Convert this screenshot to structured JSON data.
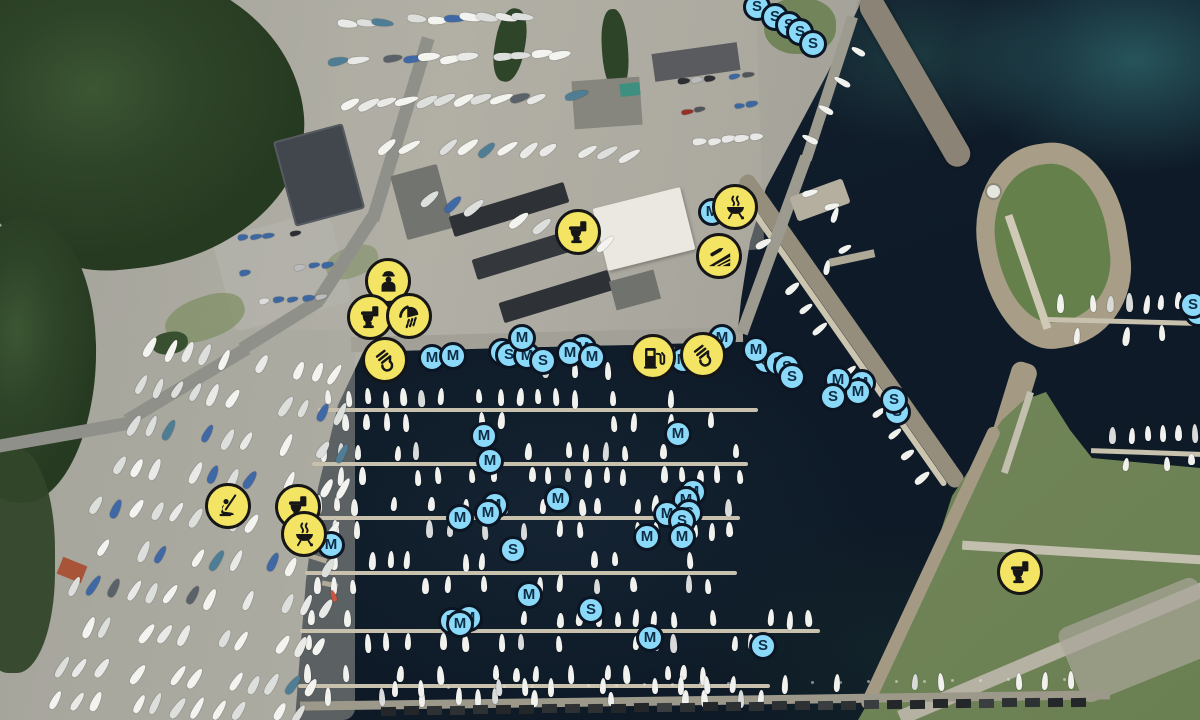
{
  "map": {
    "type": "satellite-harbour-map",
    "style": {
      "facility_fill": "#F3E464",
      "facility_stroke": "#161616",
      "facility_glyph": "#161616",
      "facility_size": 46,
      "mooring_fill": "#8AD9F8",
      "mooring_stroke": "#0B1523",
      "mooring_text": "#0D2C45",
      "mooring_size": 28
    },
    "facility_markers": [
      {
        "icon": "toilet",
        "x": 578,
        "y": 232
      },
      {
        "icon": "bbq",
        "x": 735,
        "y": 207
      },
      {
        "icon": "slipway",
        "x": 719,
        "y": 256
      },
      {
        "icon": "harbourmaster",
        "x": 388,
        "y": 281
      },
      {
        "icon": "toilet",
        "x": 370,
        "y": 317
      },
      {
        "icon": "shower",
        "x": 409,
        "y": 316
      },
      {
        "icon": "crane",
        "x": 385,
        "y": 360
      },
      {
        "icon": "fuel",
        "x": 653,
        "y": 357
      },
      {
        "icon": "crane",
        "x": 703,
        "y": 355
      },
      {
        "icon": "playground",
        "x": 228,
        "y": 506
      },
      {
        "icon": "toilet",
        "x": 298,
        "y": 507
      },
      {
        "icon": "bbq",
        "x": 304,
        "y": 534
      },
      {
        "icon": "toilet",
        "x": 1020,
        "y": 572
      }
    ],
    "mooring_markers": [
      {
        "letter": "S",
        "x": 757,
        "y": 7
      },
      {
        "letter": "S",
        "x": 775,
        "y": 17
      },
      {
        "letter": "S",
        "x": 789,
        "y": 25
      },
      {
        "letter": "S",
        "x": 800,
        "y": 32
      },
      {
        "letter": "S",
        "x": 813,
        "y": 44
      },
      {
        "letter": "M",
        "x": 712,
        "y": 212
      },
      {
        "letter": "M",
        "x": 432,
        "y": 358
      },
      {
        "letter": "M",
        "x": 453,
        "y": 356
      },
      {
        "letter": "S",
        "x": 502,
        "y": 352
      },
      {
        "letter": "S",
        "x": 509,
        "y": 355
      },
      {
        "letter": "M",
        "x": 527,
        "y": 356
      },
      {
        "letter": "M",
        "x": 522,
        "y": 338
      },
      {
        "letter": "S",
        "x": 543,
        "y": 361
      },
      {
        "letter": "M",
        "x": 583,
        "y": 348
      },
      {
        "letter": "M",
        "x": 570,
        "y": 353
      },
      {
        "letter": "M",
        "x": 592,
        "y": 357
      },
      {
        "letter": "M",
        "x": 683,
        "y": 360
      },
      {
        "letter": "M",
        "x": 722,
        "y": 338
      },
      {
        "letter": "S",
        "x": 766,
        "y": 361
      },
      {
        "letter": "M",
        "x": 756,
        "y": 350
      },
      {
        "letter": "S",
        "x": 778,
        "y": 363
      },
      {
        "letter": "S",
        "x": 787,
        "y": 367
      },
      {
        "letter": "S",
        "x": 792,
        "y": 377
      },
      {
        "letter": "M",
        "x": 862,
        "y": 383
      },
      {
        "letter": "M",
        "x": 858,
        "y": 392
      },
      {
        "letter": "M",
        "x": 838,
        "y": 380
      },
      {
        "letter": "S",
        "x": 833,
        "y": 397
      },
      {
        "letter": "S",
        "x": 897,
        "y": 412
      },
      {
        "letter": "S",
        "x": 894,
        "y": 400
      },
      {
        "letter": "S",
        "x": 1198,
        "y": 313
      },
      {
        "letter": "S",
        "x": 1193,
        "y": 305
      },
      {
        "letter": "M",
        "x": 484,
        "y": 436
      },
      {
        "letter": "M",
        "x": 490,
        "y": 461
      },
      {
        "letter": "M",
        "x": 678,
        "y": 434
      },
      {
        "letter": "M",
        "x": 558,
        "y": 499
      },
      {
        "letter": "M",
        "x": 495,
        "y": 505
      },
      {
        "letter": "M",
        "x": 488,
        "y": 513
      },
      {
        "letter": "M",
        "x": 460,
        "y": 518
      },
      {
        "letter": "M",
        "x": 693,
        "y": 492
      },
      {
        "letter": "M",
        "x": 686,
        "y": 500
      },
      {
        "letter": "S",
        "x": 689,
        "y": 513
      },
      {
        "letter": "M",
        "x": 667,
        "y": 514
      },
      {
        "letter": "S",
        "x": 682,
        "y": 521
      },
      {
        "letter": "M",
        "x": 647,
        "y": 537
      },
      {
        "letter": "M",
        "x": 682,
        "y": 537
      },
      {
        "letter": "S",
        "x": 513,
        "y": 550
      },
      {
        "letter": "M",
        "x": 331,
        "y": 545
      },
      {
        "letter": "M",
        "x": 452,
        "y": 621
      },
      {
        "letter": "M",
        "x": 469,
        "y": 618
      },
      {
        "letter": "M",
        "x": 460,
        "y": 624
      },
      {
        "letter": "M",
        "x": 529,
        "y": 595
      },
      {
        "letter": "S",
        "x": 591,
        "y": 610
      },
      {
        "letter": "M",
        "x": 650,
        "y": 638
      },
      {
        "letter": "S",
        "x": 763,
        "y": 646
      }
    ]
  }
}
